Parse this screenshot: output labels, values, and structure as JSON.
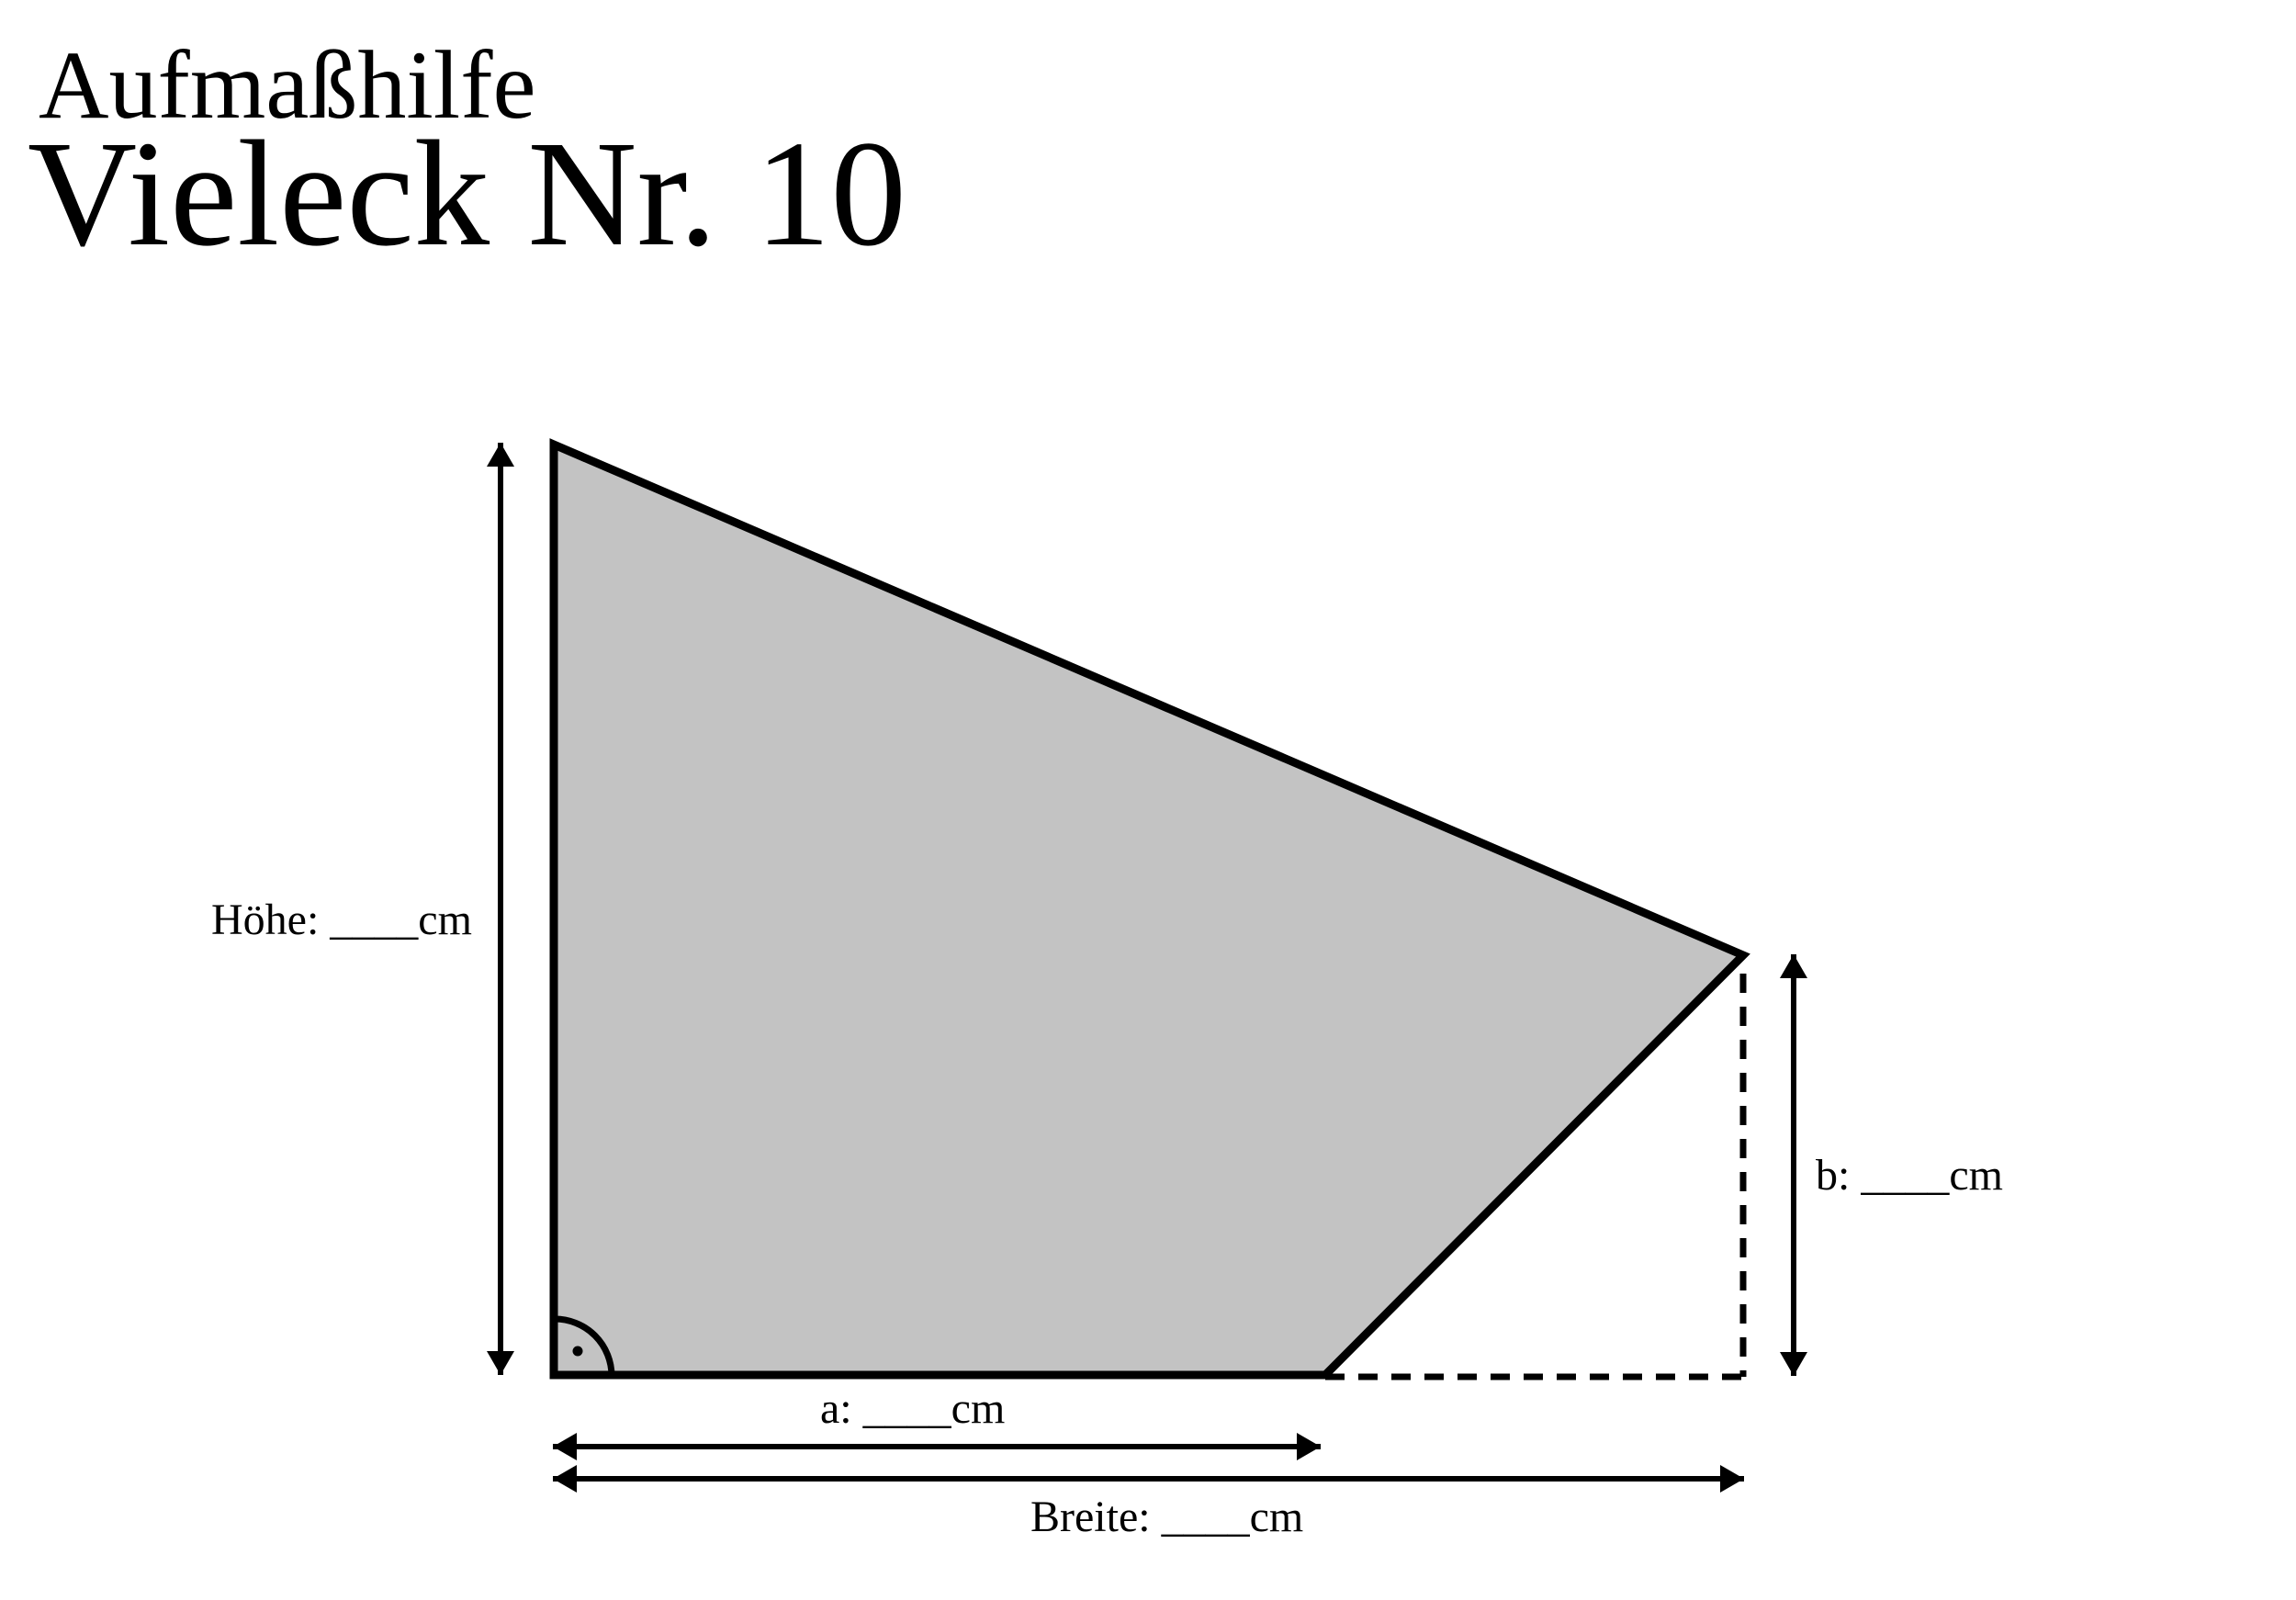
{
  "document": {
    "subtitle": "Aufmaßhilfe",
    "title": "Vieleck Nr. 10"
  },
  "dimension_labels": {
    "hoehe": "Höhe: ____cm",
    "a": "a: ____cm",
    "b": "b: ____cm",
    "breite": "Breite: ____cm"
  },
  "figure": {
    "fill_color": "#c3c3c3",
    "line_color": "#000000",
    "background_color": "#ffffff"
  }
}
